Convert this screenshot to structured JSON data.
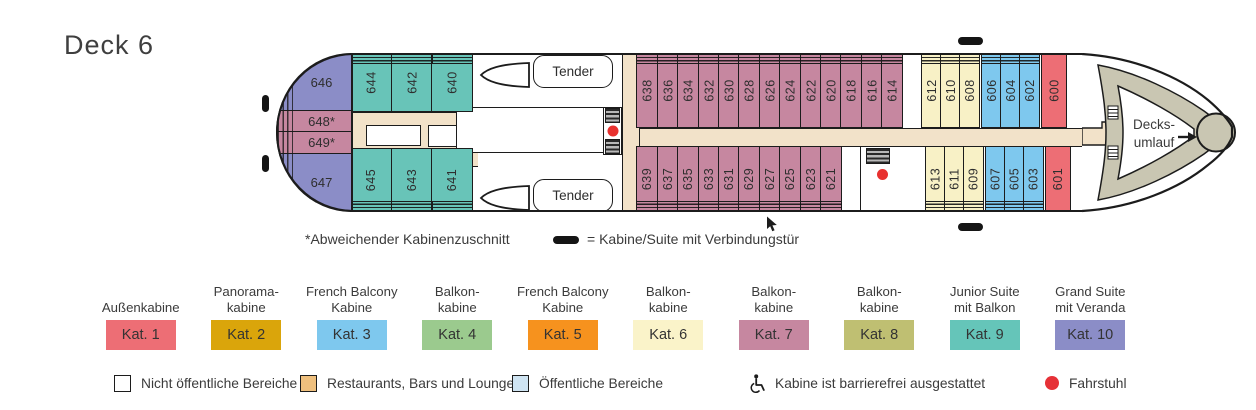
{
  "title": "Deck 6",
  "notes": {
    "asterisk": "*Abweichender Kabinenzuschnitt",
    "connecting_door": "= Kabine/Suite mit Verbindungstür"
  },
  "ship": {
    "tender_label": "Tender",
    "bow": {
      "line1": "Decks-",
      "line2": "umlauf"
    },
    "stern_cabins": [
      "646",
      "648*",
      "649*",
      "647"
    ],
    "top_teal": [
      "644",
      "642",
      "640"
    ],
    "bottom_teal": [
      "645",
      "643",
      "641"
    ],
    "top_mauve": [
      "638",
      "636",
      "634",
      "632",
      "630",
      "628",
      "626",
      "624",
      "622",
      "620",
      "618",
      "616",
      "614"
    ],
    "bottom_mauve": [
      "639",
      "637",
      "635",
      "633",
      "631",
      "629",
      "627",
      "625",
      "623",
      "621"
    ],
    "top_yellow": [
      "612",
      "610",
      "608"
    ],
    "bottom_yellow": [
      "613",
      "611",
      "609"
    ],
    "top_blue": [
      "606",
      "604",
      "602"
    ],
    "bottom_blue": [
      "607",
      "605",
      "603"
    ],
    "top_red": [
      "600"
    ],
    "bottom_red": [
      "601"
    ]
  },
  "categories": [
    {
      "label": "Außenkabine",
      "kat": "Kat. 1",
      "color": "#ed6e75"
    },
    {
      "label": "Panorama-\nkabine",
      "kat": "Kat. 2",
      "color": "#daa50b"
    },
    {
      "label": "French Balcony\nKabine",
      "kat": "Kat. 3",
      "color": "#7ec8ee"
    },
    {
      "label": "Balkon-\nkabine",
      "kat": "Kat. 4",
      "color": "#9bca8e"
    },
    {
      "label": "French Balcony\nKabine",
      "kat": "Kat. 5",
      "color": "#f6921e"
    },
    {
      "label": "Balkon-\nkabine",
      "kat": "Kat. 6",
      "color": "#faf3c9"
    },
    {
      "label": "Balkon-\nkabine",
      "kat": "Kat. 7",
      "color": "#c687a0"
    },
    {
      "label": "Balkon-\nkabine",
      "kat": "Kat. 8",
      "color": "#bfbf72"
    },
    {
      "label": "Junior Suite\nmit Balkon",
      "kat": "Kat. 9",
      "color": "#65c5b9"
    },
    {
      "label": "Grand Suite\nmit Veranda",
      "kat": "Kat. 10",
      "color": "#8b8dc7"
    }
  ],
  "area_legend": [
    {
      "label": "Nicht öffentliche Bereiche"
    },
    {
      "label": "Restaurants, Bars und Lounges",
      "color": "#efc07e"
    },
    {
      "label": "Öffentliche Bereiche",
      "color": "#cfe4f2"
    },
    {
      "label": "Kabine ist barrierefrei ausgestattet"
    },
    {
      "label": "Fahrstuhl",
      "color": "#e63137"
    }
  ]
}
